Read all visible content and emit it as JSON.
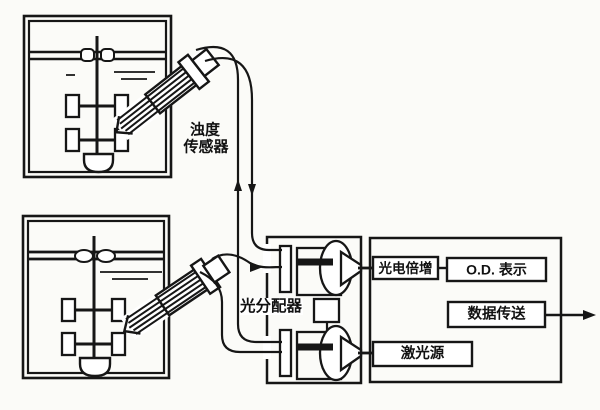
{
  "diagram": {
    "type": "schematic",
    "description_visible_text_only": true,
    "colors": {
      "ink": "#161616",
      "paper": "#fbfbf8"
    },
    "labels": {
      "turbidity_sensor_line1": "浊度",
      "turbidity_sensor_line2": "传感器",
      "light_distributor": "光分配器",
      "photomultiplier": "光电倍增",
      "od_display": "O.D. 表示",
      "data_transfer": "数据传送",
      "laser_source": "激光源"
    }
  }
}
